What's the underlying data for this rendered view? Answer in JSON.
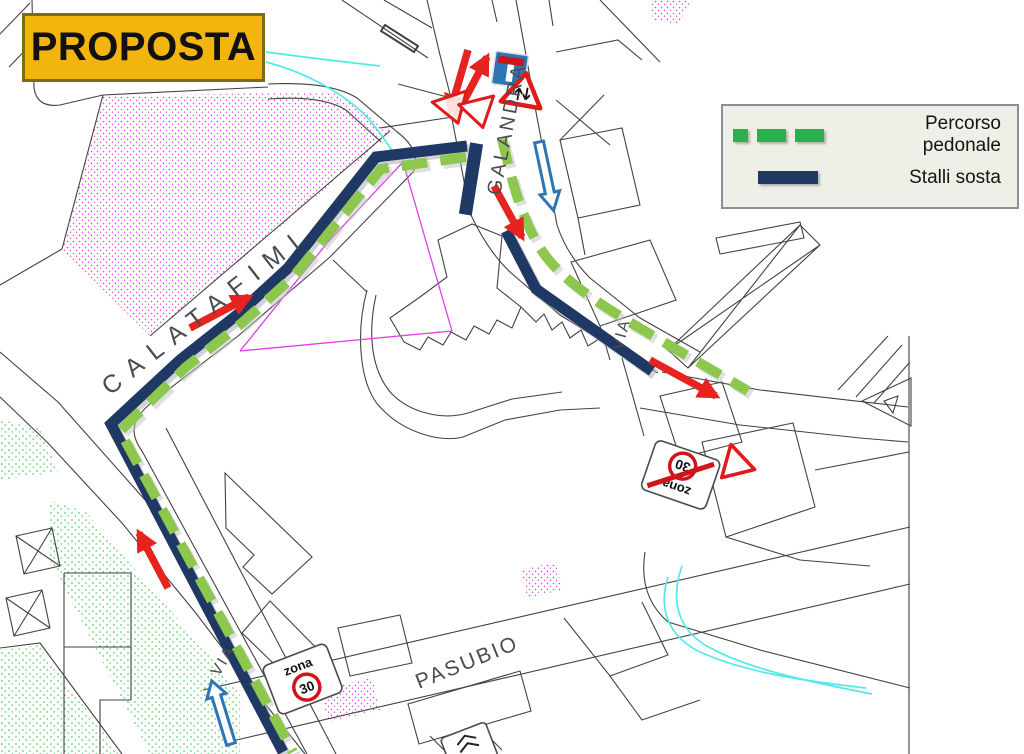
{
  "title": {
    "label": "PROPOSTA"
  },
  "legend": {
    "items": [
      {
        "label": "Percorso pedonale",
        "swatch": "green-dashed",
        "color": "#2bb04f"
      },
      {
        "label": "Stalli sosta",
        "swatch": "navy-solid",
        "color": "#1f3864"
      }
    ]
  },
  "map": {
    "street_labels": {
      "calatafimi": "CALATAFIMI",
      "galandra": "GALANDRA",
      "via": "VIA",
      "pasubio": "PASUBIO"
    },
    "signs": {
      "zona_30": {
        "word": "zona",
        "limit": "30"
      }
    },
    "icons": {
      "red_arrow": "direction-flow-arrow",
      "blue_arrow": "one-way-street-arrow",
      "dead_end_sign": "dead-end-street-sign",
      "two_way_sign": "two-way-traffic-warning-sign",
      "yield_sign": "yield-triangle-sign",
      "zona30_start": "zone-30-start-sign",
      "zona30_end": "zone-30-end-sign-crossed"
    },
    "colors": {
      "pedestrian_path": "#8dc74e",
      "parking_stalls": "#1f3864",
      "red_arrow": "#e6231e",
      "blue_arrow": "#2e75b6",
      "title_bg": "#f2b50d",
      "stream_cyan": "#55e8e8",
      "parcel_magenta": "#e23ce2",
      "stipple_green": "#2ec43a",
      "legend_bg": "#eef0e7"
    }
  }
}
